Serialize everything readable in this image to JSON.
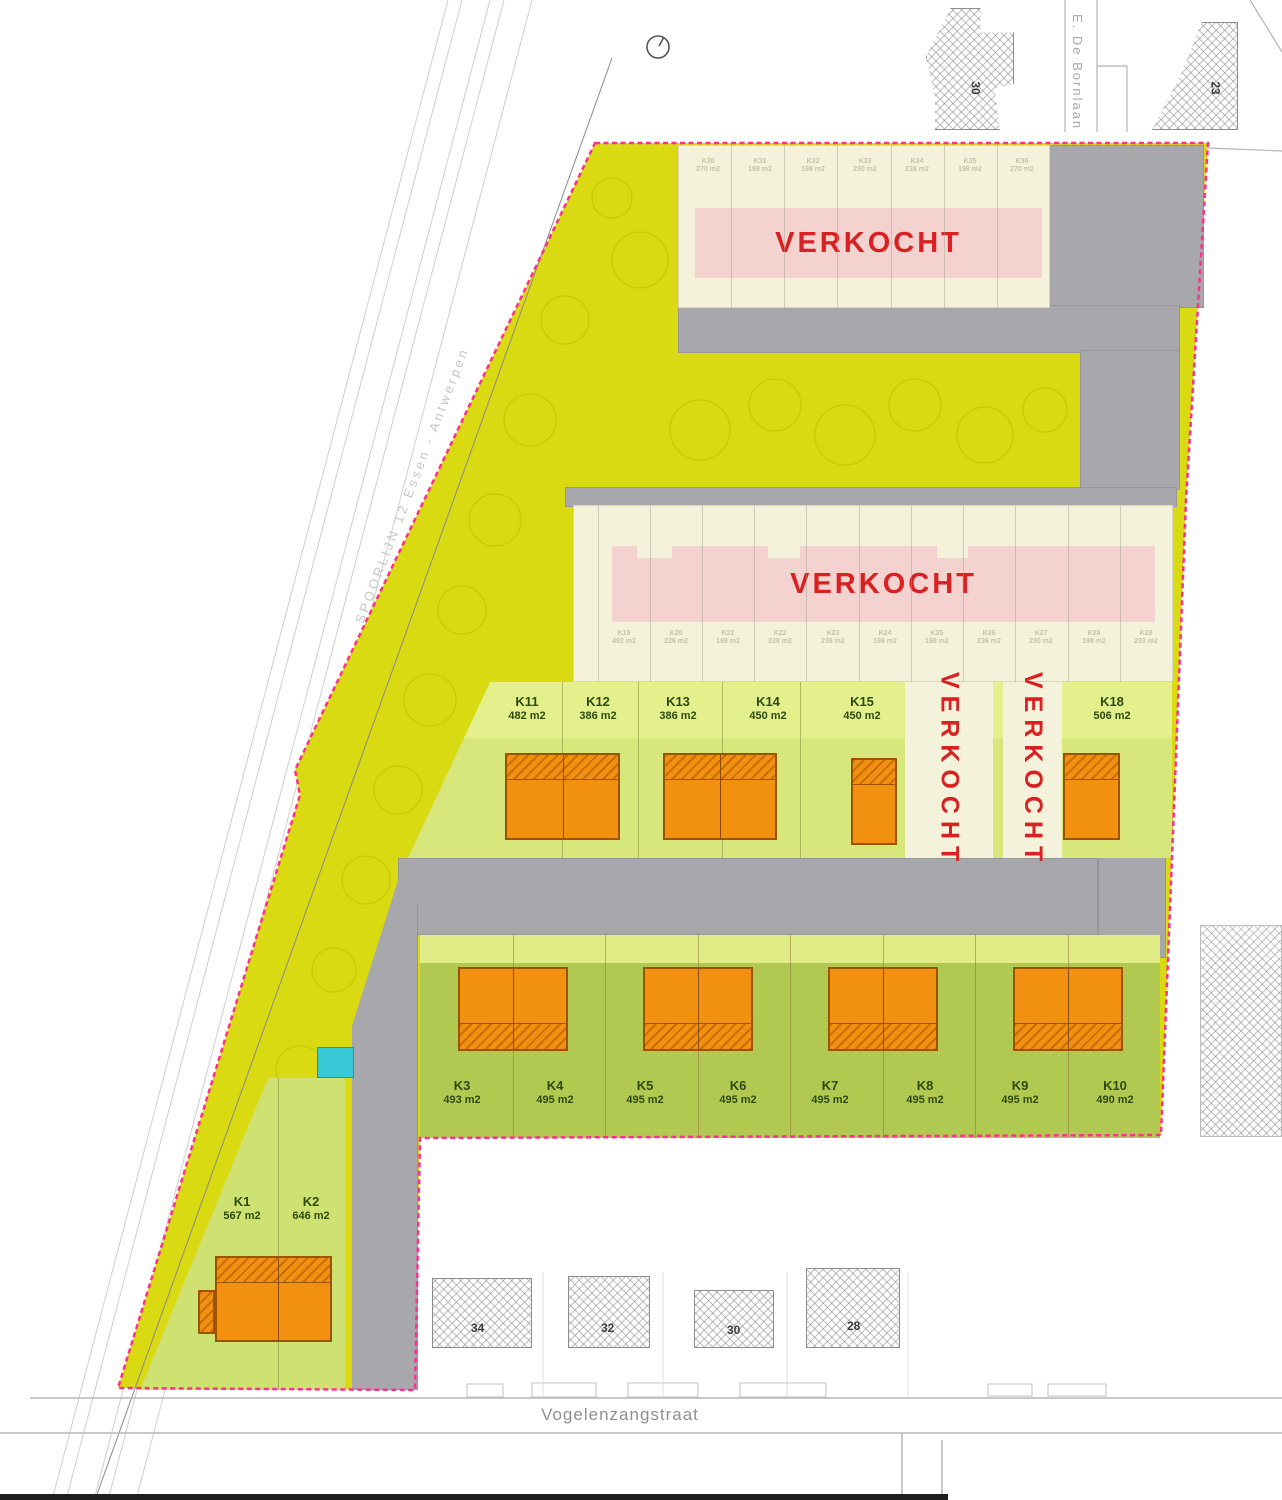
{
  "plan": {
    "sold_label": "VERKOCHT",
    "streets": {
      "bottom": "Vogelenzangstraat",
      "side": "E. De Bornlaan",
      "railway": "SPOORLIJN 12 Essen - Antwerpen"
    },
    "top_block": {
      "sold": "VERKOCHT",
      "lots": [
        {
          "id": "K30",
          "area": "270 m2"
        },
        {
          "id": "K31",
          "area": "198 m2"
        },
        {
          "id": "K32",
          "area": "198 m2"
        },
        {
          "id": "K33",
          "area": "230 m2"
        },
        {
          "id": "K34",
          "area": "238 m2"
        },
        {
          "id": "K35",
          "area": "198 m2"
        },
        {
          "id": "K36",
          "area": "270 m2"
        }
      ]
    },
    "middle_block": {
      "sold": "VERKOCHT",
      "lots": [
        {
          "id": "K19",
          "area": "492 m2"
        },
        {
          "id": "K20",
          "area": "226 m2"
        },
        {
          "id": "K21",
          "area": "198 m2"
        },
        {
          "id": "K22",
          "area": "238 m2"
        },
        {
          "id": "K23",
          "area": "236 m2"
        },
        {
          "id": "K24",
          "area": "198 m2"
        },
        {
          "id": "K25",
          "area": "198 m2"
        },
        {
          "id": "K26",
          "area": "236 m2"
        },
        {
          "id": "K27",
          "area": "230 m2"
        },
        {
          "id": "K28",
          "area": "198 m2"
        },
        {
          "id": "K29",
          "area": "233 m2"
        }
      ]
    },
    "row1": {
      "lots": [
        {
          "id": "K11",
          "area": "482 m2"
        },
        {
          "id": "K12",
          "area": "386 m2"
        },
        {
          "id": "K13",
          "area": "386 m2"
        },
        {
          "id": "K14",
          "area": "450 m2"
        },
        {
          "id": "K15",
          "area": "450 m2"
        },
        {
          "id": "K18",
          "area": "506 m2"
        }
      ],
      "sold_lots": [
        "VERKOCHT",
        "VERKOCHT"
      ]
    },
    "row2": {
      "lots": [
        {
          "id": "K3",
          "area": "493 m2"
        },
        {
          "id": "K4",
          "area": "495 m2"
        },
        {
          "id": "K5",
          "area": "495 m2"
        },
        {
          "id": "K6",
          "area": "495 m2"
        },
        {
          "id": "K7",
          "area": "495 m2"
        },
        {
          "id": "K8",
          "area": "495 m2"
        },
        {
          "id": "K9",
          "area": "495 m2"
        },
        {
          "id": "K10",
          "area": "490 m2"
        }
      ]
    },
    "front": {
      "lots": [
        {
          "id": "K1",
          "area": "567 m2"
        },
        {
          "id": "K2",
          "area": "646 m2"
        }
      ]
    },
    "neighbors": {
      "bottom": [
        "34",
        "32",
        "30",
        "28"
      ],
      "top_right": [
        "30",
        "23"
      ]
    },
    "colors": {
      "site_yellow": "#d9da12",
      "lot_green_light": "#d7e77b",
      "lot_green": "#b2c951",
      "building_orange": "#f2900f",
      "sold_pink": "#f3d2d0",
      "sold_red": "#d92121",
      "boundary_pink": "#ff2f90",
      "road_gray": "#a8a8ac",
      "utility_cyan": "#38c9d6"
    }
  }
}
